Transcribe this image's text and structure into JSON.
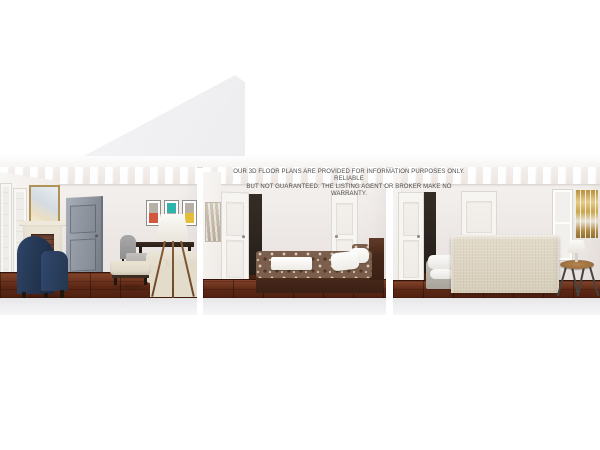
{
  "disclaimer": {
    "line1": "OUR 3D FLOOR PLANS ARE PROVIDED FOR INFORMATION PURPOSES ONLY. RELIABLE",
    "line2": "BUT NOT GUARANTEED. THE LISTING AGENT OR BROKER MAKE NO WARRANTY.",
    "color": "#4e4e4e"
  },
  "scene": {
    "type": "3d-floor-plan-dollhouse-cutaway",
    "background": "#ffffff",
    "sections": [
      {
        "id": "living-room",
        "furniture": [
          "french-door-panels",
          "gilt-framed-mirror",
          "fireplace-with-brick-firebox",
          "gray-paneled-open-door",
          "triptych-wall-art",
          "gray-dining-chair",
          "dark-wood-dining-table",
          "gray-upholstered-bench",
          "cream-sofa",
          "tripod-floor-lamp",
          "cream-ottoman",
          "navy-wingback-chair"
        ]
      },
      {
        "id": "bedroom-1",
        "furniture": [
          "neutral-canvas-art",
          "open-white-paneled-door",
          "closed-white-paneled-door",
          "dark-wood-platform-bed",
          "damask-duvet",
          "white-folded-throw",
          "white-pillows",
          "damask-accent-pillow"
        ]
      },
      {
        "id": "bedroom-2",
        "furniture": [
          "open-door-with-dark-doorway",
          "closed-white-paneled-door",
          "beige-upholstered-bed-back",
          "layered-bedding",
          "white-window",
          "autumn-trees-painting",
          "white-table-lamp",
          "round-wood-side-table"
        ]
      }
    ]
  },
  "palette": {
    "wall": "#ece7e4",
    "ceiling": "#ffffff",
    "floor_wood": "#5c2715",
    "slab_edge": "#e9e9eb",
    "wedge": "#f1f1f3",
    "navy_chair": "#253a5e",
    "gray_door": "#8d939d",
    "art_orange": "#d2573d",
    "art_teal": "#2fb3ab",
    "art_yellow": "#e5be39",
    "duvet_brown": "#7b5f4c",
    "bed_wood": "#46281a",
    "headboard_beige": "#dcd4c2",
    "painting_gold": "#c9a64e",
    "side_table_wood": "#a87e4b"
  }
}
